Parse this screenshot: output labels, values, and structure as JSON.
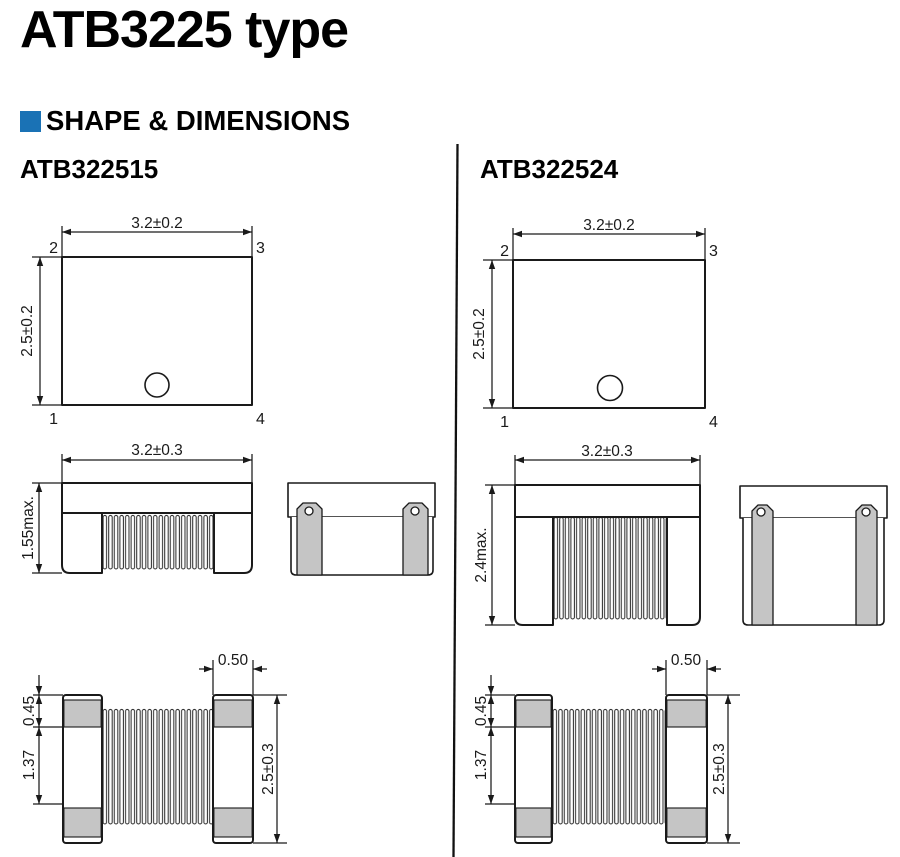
{
  "page": {
    "title": "ATB3225 type",
    "section": "SHAPE & DIMENSIONS",
    "colors": {
      "accent": "#1a72b5",
      "line": "#1a1a1a",
      "terminal_gray": "#c5c5c5"
    }
  },
  "columns": {
    "left": {
      "part_number": "ATB322515",
      "top_view": {
        "width": "3.2±0.2",
        "height": "2.5±0.2",
        "pin_top_left": "2",
        "pin_top_right": "3",
        "pin_bottom_left": "1",
        "pin_bottom_right": "4"
      },
      "side_view": {
        "width": "3.2±0.3",
        "height": "1.55max."
      },
      "bottom_view": {
        "terminal_width": "0.50",
        "terminal_band": "0.45",
        "inner_length": "1.37",
        "height": "2.5±0.3"
      }
    },
    "right": {
      "part_number": "ATB322524",
      "top_view": {
        "width": "3.2±0.2",
        "height": "2.5±0.2",
        "pin_top_left": "2",
        "pin_top_right": "3",
        "pin_bottom_left": "1",
        "pin_bottom_right": "4"
      },
      "side_view": {
        "width": "3.2±0.3",
        "height": "2.4max."
      },
      "bottom_view": {
        "terminal_width": "0.50",
        "terminal_band": "0.45",
        "inner_length": "1.37",
        "height": "2.5±0.3"
      }
    }
  }
}
